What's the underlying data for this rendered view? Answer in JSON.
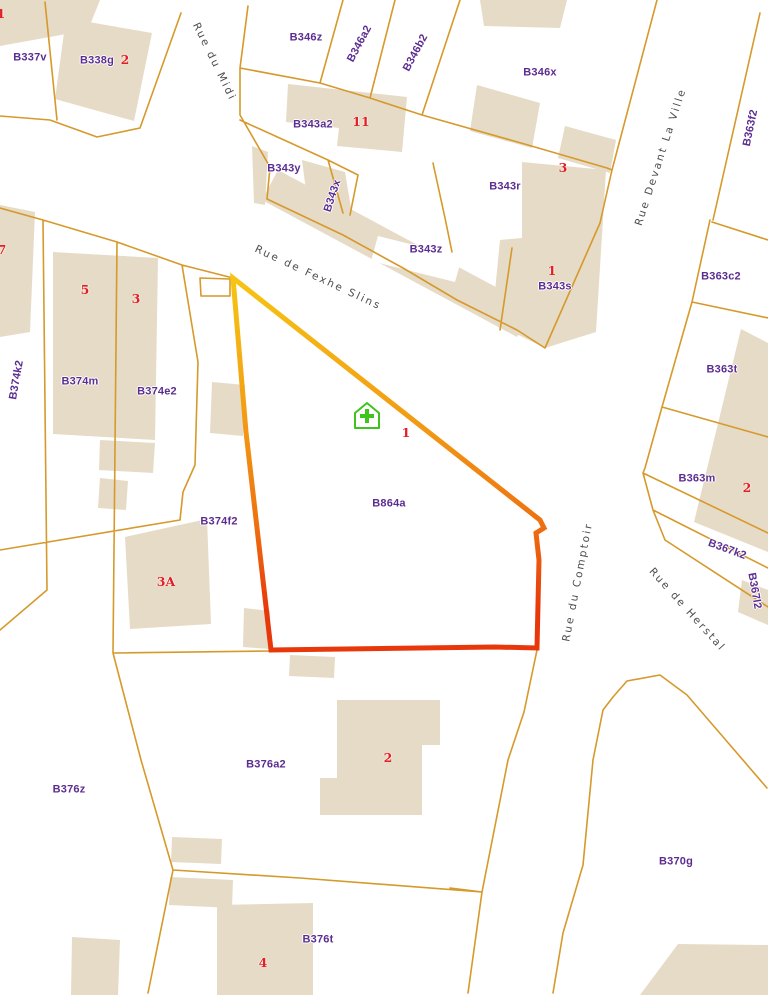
{
  "map": {
    "type": "cadastral-parcel-map",
    "colors": {
      "background": "#FFFFFF",
      "parcel_line": "#D6992B",
      "building_fill": "#E6DBC6",
      "parcel_label": "#5C2D91",
      "house_number": "#E31E24",
      "street_label": "#4D4D4D",
      "house_icon_green": "#3FC41E",
      "selection_gradient": [
        "#F6C513",
        "#F29B14",
        "#EE7110",
        "#E8380B"
      ]
    },
    "selected_parcel": {
      "parcel_id": "B864a",
      "house_number": "1"
    },
    "parcel_labels": [
      {
        "text": "B337v",
        "x": 30,
        "y": 58,
        "rot": 0
      },
      {
        "text": "B338g",
        "x": 97,
        "y": 61,
        "rot": 0
      },
      {
        "text": "B346z",
        "x": 306,
        "y": 38,
        "rot": 0
      },
      {
        "text": "B346a2",
        "x": 360,
        "y": 44,
        "rot": -62
      },
      {
        "text": "B346b2",
        "x": 416,
        "y": 53,
        "rot": -62
      },
      {
        "text": "B346x",
        "x": 540,
        "y": 73,
        "rot": 0
      },
      {
        "text": "B343a2",
        "x": 313,
        "y": 125,
        "rot": 0
      },
      {
        "text": "B343y",
        "x": 284,
        "y": 169,
        "rot": 0
      },
      {
        "text": "B343x",
        "x": 333,
        "y": 196,
        "rot": -72
      },
      {
        "text": "B343z",
        "x": 426,
        "y": 250,
        "rot": 0
      },
      {
        "text": "B343r",
        "x": 505,
        "y": 187,
        "rot": 0
      },
      {
        "text": "B343s",
        "x": 555,
        "y": 287,
        "rot": 0
      },
      {
        "text": "B363f2",
        "x": 751,
        "y": 128,
        "rot": -78
      },
      {
        "text": "B363c2",
        "x": 721,
        "y": 277,
        "rot": 0
      },
      {
        "text": "B363t",
        "x": 722,
        "y": 370,
        "rot": 0
      },
      {
        "text": "B363m",
        "x": 697,
        "y": 479,
        "rot": 0
      },
      {
        "text": "B367k2",
        "x": 727,
        "y": 550,
        "rot": 20
      },
      {
        "text": "B367l2",
        "x": 754,
        "y": 591,
        "rot": 80
      },
      {
        "text": "B374k2",
        "x": 17,
        "y": 380,
        "rot": -80
      },
      {
        "text": "B374m",
        "x": 80,
        "y": 382,
        "rot": 0
      },
      {
        "text": "B374e2",
        "x": 157,
        "y": 392,
        "rot": 0
      },
      {
        "text": "B374f2",
        "x": 219,
        "y": 522,
        "rot": 0
      },
      {
        "text": "B864a",
        "x": 389,
        "y": 504,
        "rot": 0
      },
      {
        "text": "B376z",
        "x": 69,
        "y": 790,
        "rot": 0
      },
      {
        "text": "B376a2",
        "x": 266,
        "y": 765,
        "rot": 0
      },
      {
        "text": "B376t",
        "x": 318,
        "y": 940,
        "rot": 0
      },
      {
        "text": "B370g",
        "x": 676,
        "y": 862,
        "rot": 0
      }
    ],
    "house_numbers": [
      {
        "text": "1",
        "x": 1,
        "y": 14
      },
      {
        "text": "2",
        "x": 125,
        "y": 60
      },
      {
        "text": "11",
        "x": 361,
        "y": 122
      },
      {
        "text": "3",
        "x": 563,
        "y": 168
      },
      {
        "text": "1",
        "x": 552,
        "y": 271
      },
      {
        "text": "7",
        "x": 2,
        "y": 250
      },
      {
        "text": "5",
        "x": 85,
        "y": 290
      },
      {
        "text": "3",
        "x": 136,
        "y": 299
      },
      {
        "text": "1",
        "x": 406,
        "y": 433
      },
      {
        "text": "3A",
        "x": 166,
        "y": 582
      },
      {
        "text": "2",
        "x": 747,
        "y": 488
      },
      {
        "text": "2",
        "x": 388,
        "y": 758
      },
      {
        "text": "4",
        "x": 263,
        "y": 963
      }
    ],
    "street_labels": [
      {
        "text": "Rue du Midi",
        "x": 214,
        "y": 62,
        "rot": 64
      },
      {
        "text": "Rue de Fexhe Slins",
        "x": 318,
        "y": 278,
        "rot": 25
      },
      {
        "text": "Rue Devant La Ville",
        "x": 661,
        "y": 157,
        "rot": -72
      },
      {
        "text": "Rue du Comptoir",
        "x": 578,
        "y": 582,
        "rot": -79
      },
      {
        "text": "Rue de Herstal",
        "x": 687,
        "y": 610,
        "rot": 48
      }
    ]
  }
}
